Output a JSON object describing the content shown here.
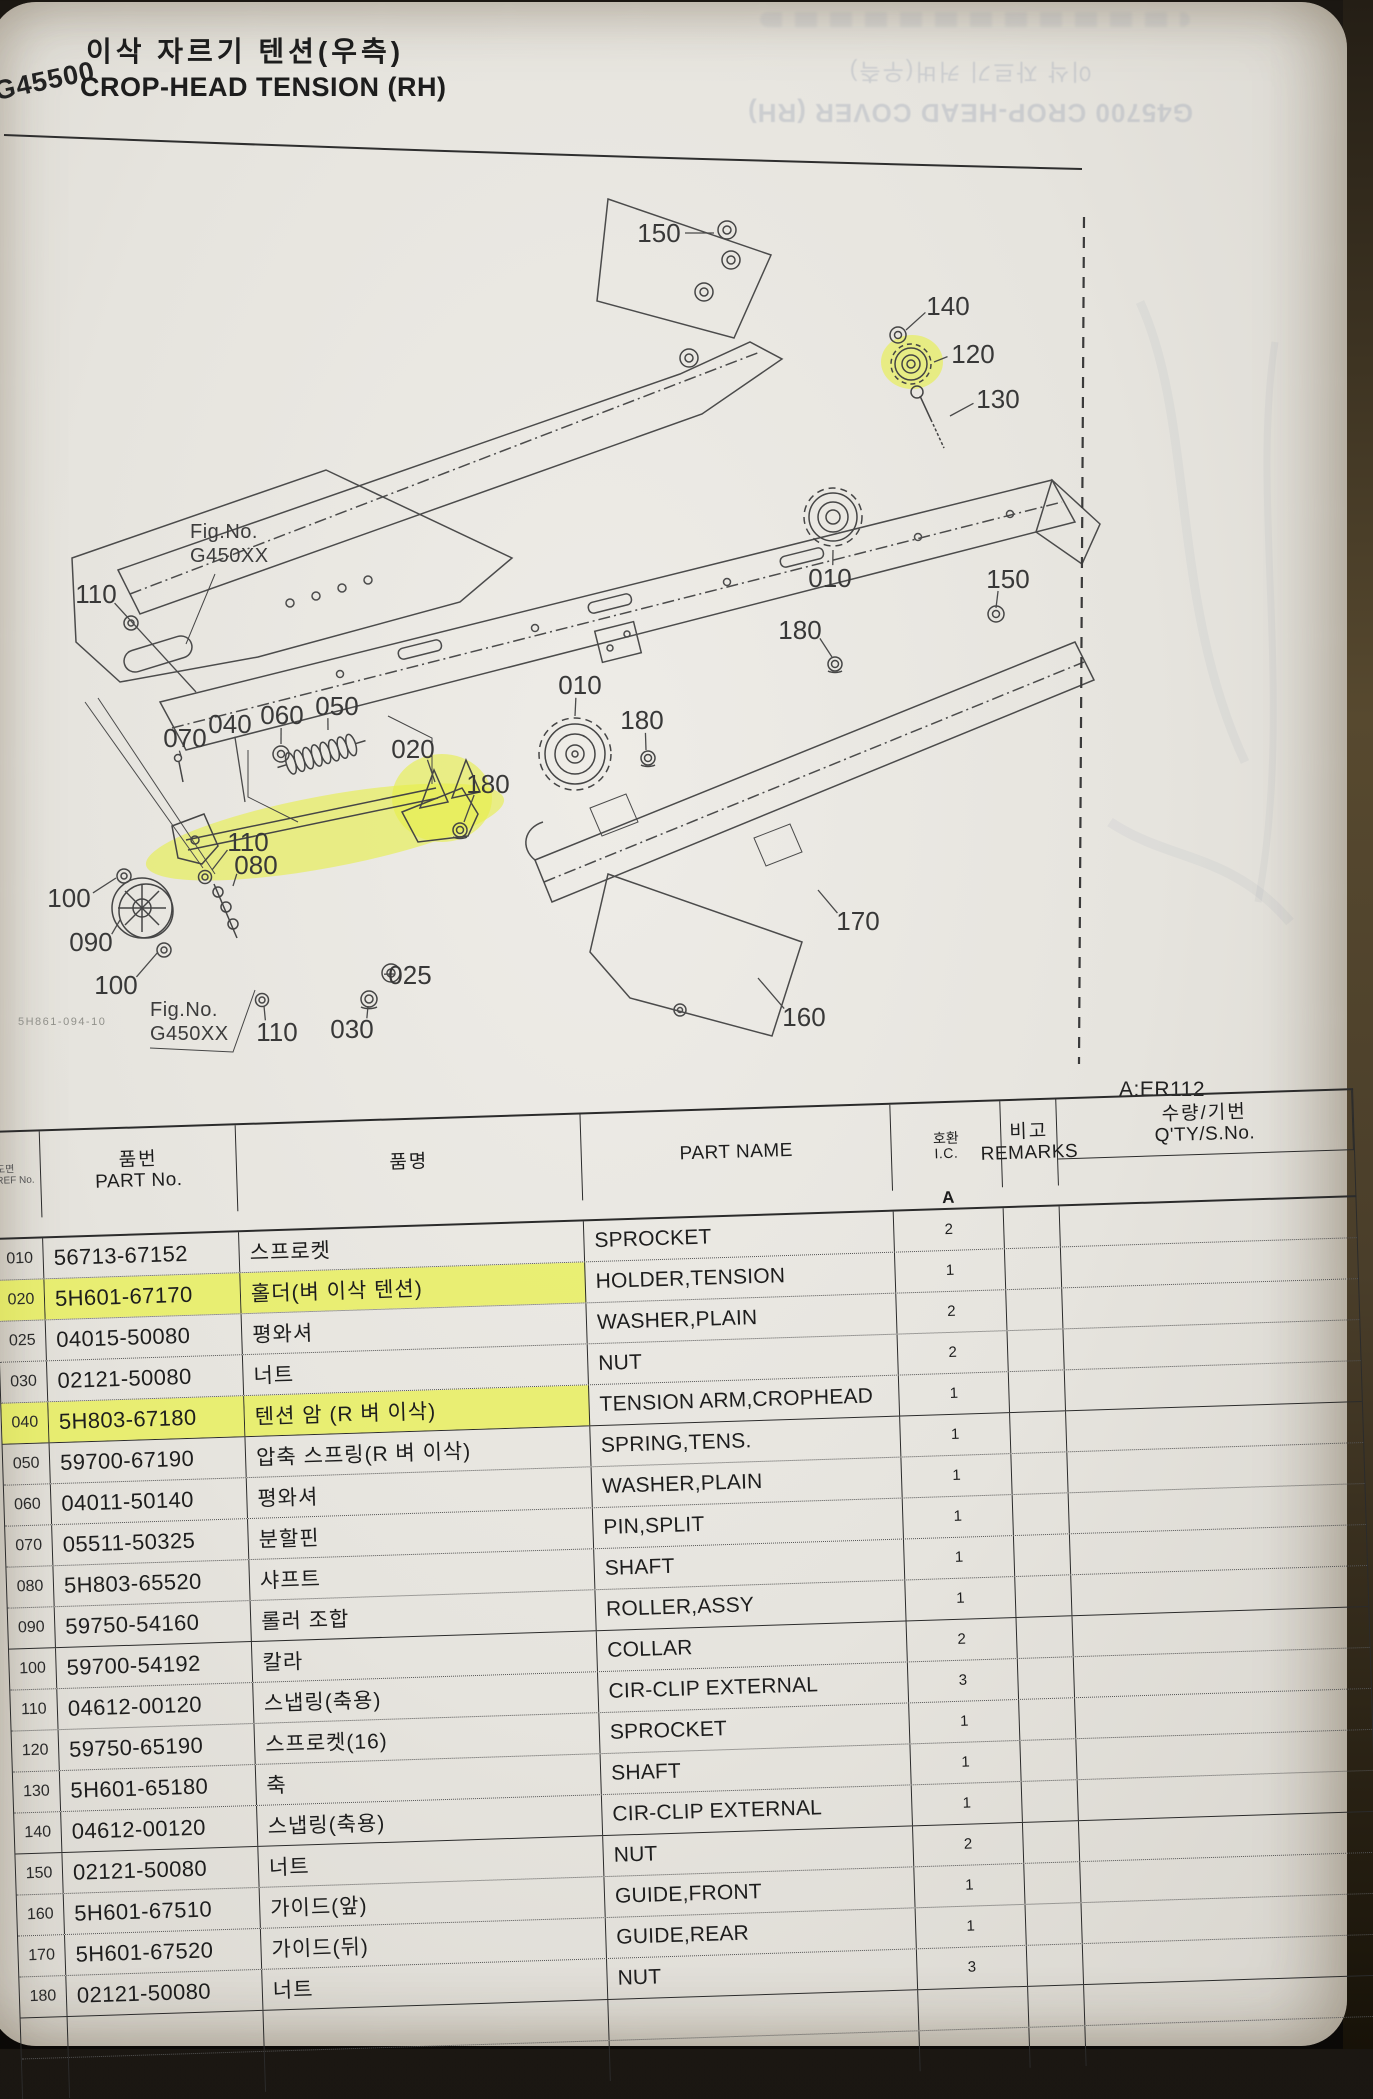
{
  "page": {
    "code": "G45500",
    "title_ko": "이삭 자르기 텐션(우측)",
    "title_en": "CROP-HEAD TENSION (RH)",
    "plate_ref": "A:ER112",
    "doc_code": "5H861-094-10"
  },
  "ghost": {
    "line_en": "G45700  CROP-HEAD COVER (RH)",
    "line_ko": "이삭 자르기 커버(우측)"
  },
  "diagram": {
    "fig_no_label": "Fig.No.",
    "fig_no_code": "G450XX",
    "callouts": [
      {
        "t": "150",
        "x": 669,
        "y": 231,
        "lx": 724,
        "ly": 231
      },
      {
        "t": "140",
        "x": 958,
        "y": 304,
        "lx": 916,
        "ly": 328
      },
      {
        "t": "120",
        "x": 983,
        "y": 352,
        "lx": 944,
        "ly": 360
      },
      {
        "t": "130",
        "x": 1008,
        "y": 397,
        "lx": 960,
        "ly": 414
      },
      {
        "t": "180",
        "x": 810,
        "y": 628,
        "lx": 842,
        "ly": 655
      },
      {
        "t": "010",
        "x": 840,
        "y": 576,
        "lx": 843,
        "ly": 548
      },
      {
        "t": "150",
        "x": 1018,
        "y": 577,
        "lx": 1006,
        "ly": 606
      },
      {
        "t": "010",
        "x": 590,
        "y": 683,
        "lx": 585,
        "ly": 714
      },
      {
        "t": "180",
        "x": 652,
        "y": 718,
        "lx": 656,
        "ly": 748
      },
      {
        "t": "110",
        "x": 106,
        "y": 592,
        "lx": 206,
        "ly": 690
      },
      {
        "t": "070",
        "x": 195,
        "y": 736,
        "lx": 191,
        "ly": 754
      },
      {
        "t": "040",
        "x": 240,
        "y": 722,
        "lx": 255,
        "ly": 800
      },
      {
        "t": "060",
        "x": 292,
        "y": 713,
        "lx": 291,
        "ly": 742
      },
      {
        "t": "050",
        "x": 347,
        "y": 704,
        "lx": 338,
        "ly": 728
      },
      {
        "t": "020",
        "x": 423,
        "y": 747,
        "lx": 445,
        "ly": 780
      },
      {
        "t": "180",
        "x": 498,
        "y": 782,
        "lx": 474,
        "ly": 820
      },
      {
        "t": "110",
        "x": 258,
        "y": 840,
        "lx": 222,
        "ly": 868
      },
      {
        "t": "080",
        "x": 266,
        "y": 863,
        "lx": 243,
        "ly": 884
      },
      {
        "t": "100",
        "x": 79,
        "y": 896,
        "lx": 126,
        "ly": 876
      },
      {
        "t": "090",
        "x": 101,
        "y": 940,
        "lx": 130,
        "ly": 918
      },
      {
        "t": "100",
        "x": 126,
        "y": 983,
        "lx": 168,
        "ly": 950
      },
      {
        "t": "110",
        "x": 287,
        "y": 1030,
        "lx": 274,
        "ly": 1004
      },
      {
        "t": "030",
        "x": 362,
        "y": 1027,
        "lx": 378,
        "ly": 1004
      },
      {
        "t": "025",
        "x": 420,
        "y": 973,
        "lx": 404,
        "ly": 972
      },
      {
        "t": "170",
        "x": 868,
        "y": 919,
        "lx": 828,
        "ly": 888
      },
      {
        "t": "160",
        "x": 814,
        "y": 1015,
        "lx": 768,
        "ly": 976
      }
    ]
  },
  "table": {
    "headers": {
      "ref_ko": "도면",
      "ref_en": "REF No.",
      "part_no_ko": "품번",
      "part_no_en": "PART No.",
      "name_ko": "품명",
      "part_name": "PART NAME",
      "qty_ko": "수량/기번",
      "qty_en": "Q'TY/S.No.",
      "qty_sub": "A",
      "ic_ko": "호환",
      "ic_en": "I.C.",
      "remarks_ko": "비고",
      "remarks_en": "REMARKS"
    },
    "rows": [
      {
        "ref": "010",
        "part_no": "56713-67152",
        "name_ko": "스프로켓",
        "part_name": "SPROCKET",
        "qty": "2",
        "hl": false
      },
      {
        "ref": "020",
        "part_no": "5H601-67170",
        "name_ko": "홀더(벼 이삭 텐션)",
        "part_name": "HOLDER,TENSION",
        "qty": "1",
        "hl": true
      },
      {
        "ref": "025",
        "part_no": "04015-50080",
        "name_ko": "평와셔",
        "part_name": "WASHER,PLAIN",
        "qty": "2",
        "hl": false
      },
      {
        "ref": "030",
        "part_no": "02121-50080",
        "name_ko": "너트",
        "part_name": "NUT",
        "qty": "2",
        "hl": false
      },
      {
        "ref": "040",
        "part_no": "5H803-67180",
        "name_ko": "텐션 암 (R 벼 이삭)",
        "part_name": "TENSION ARM,CROPHEAD",
        "qty": "1",
        "hl": true
      },
      {
        "ref": "050",
        "part_no": "59700-67190",
        "name_ko": "압축 스프링(R 벼 이삭)",
        "part_name": "SPRING,TENS.",
        "qty": "1",
        "hl": false
      },
      {
        "ref": "060",
        "part_no": "04011-50140",
        "name_ko": "평와셔",
        "part_name": "WASHER,PLAIN",
        "qty": "1",
        "hl": false
      },
      {
        "ref": "070",
        "part_no": "05511-50325",
        "name_ko": "분할핀",
        "part_name": "PIN,SPLIT",
        "qty": "1",
        "hl": false
      },
      {
        "ref": "080",
        "part_no": "5H803-65520",
        "name_ko": "샤프트",
        "part_name": "SHAFT",
        "qty": "1",
        "hl": false
      },
      {
        "ref": "090",
        "part_no": "59750-54160",
        "name_ko": "롤러 조합",
        "part_name": "ROLLER,ASSY",
        "qty": "1",
        "hl": false
      },
      {
        "ref": "100",
        "part_no": "59700-54192",
        "name_ko": "칼라",
        "part_name": "COLLAR",
        "qty": "2",
        "hl": false
      },
      {
        "ref": "110",
        "part_no": "04612-00120",
        "name_ko": "스냅링(축용)",
        "part_name": "CIR-CLIP EXTERNAL",
        "qty": "3",
        "hl": false
      },
      {
        "ref": "120",
        "part_no": "59750-65190",
        "name_ko": "스프로켓(16)",
        "part_name": "SPROCKET",
        "qty": "1",
        "hl": false
      },
      {
        "ref": "130",
        "part_no": "5H601-65180",
        "name_ko": "축",
        "part_name": "SHAFT",
        "qty": "1",
        "hl": false
      },
      {
        "ref": "140",
        "part_no": "04612-00120",
        "name_ko": "스냅링(축용)",
        "part_name": "CIR-CLIP EXTERNAL",
        "qty": "1",
        "hl": false
      },
      {
        "ref": "150",
        "part_no": "02121-50080",
        "name_ko": "너트",
        "part_name": "NUT",
        "qty": "2",
        "hl": false
      },
      {
        "ref": "160",
        "part_no": "5H601-67510",
        "name_ko": "가이드(앞)",
        "part_name": "GUIDE,FRONT",
        "qty": "1",
        "hl": false
      },
      {
        "ref": "170",
        "part_no": "5H601-67520",
        "name_ko": "가이드(뒤)",
        "part_name": "GUIDE,REAR",
        "qty": "1",
        "hl": false
      },
      {
        "ref": "180",
        "part_no": "02121-50080",
        "name_ko": "너트",
        "part_name": "NUT",
        "qty": "3",
        "hl": false
      }
    ]
  }
}
